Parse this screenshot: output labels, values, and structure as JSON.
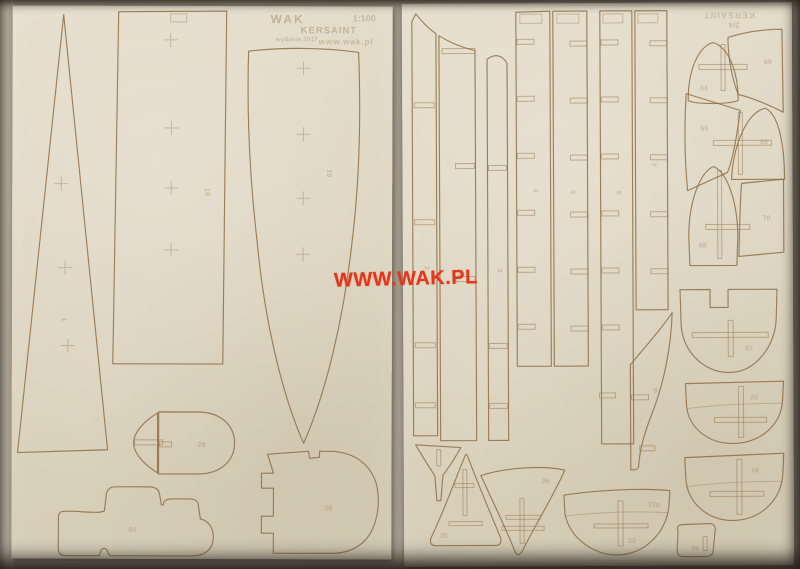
{
  "watermark": {
    "text": "WWW.WAK.PL",
    "color": "#e5361a"
  },
  "sheet_left": {
    "header": {
      "brand": "WAK",
      "scale": "1:100",
      "title": "KERSAINT",
      "edition": "wydanie 2017",
      "site": "www.wak.pl"
    },
    "labels": {
      "triangle": "1",
      "rectangle": "18",
      "deck": "19",
      "dome": "29",
      "bone": "84",
      "boot": "28"
    }
  },
  "sheet_right": {
    "corner": {
      "number": "2/4",
      "title": "KERSAINT"
    },
    "labels": {
      "plank1": "2",
      "plank2": "2a",
      "plank3": "3",
      "strip1": "4",
      "strip2": "5",
      "strip3": "6",
      "strip4": "7",
      "stern": "8",
      "bell_top": "64",
      "fan_top": "69",
      "fan_left": "65",
      "bell_right": "66",
      "bell_left": "68",
      "fan_right": "70",
      "dome_notched": "67",
      "frame_a": "20",
      "frame_b": "18",
      "hull": "23",
      "hull_top": "23a",
      "aframe": "25",
      "fin": "26",
      "wedge": "39"
    }
  }
}
